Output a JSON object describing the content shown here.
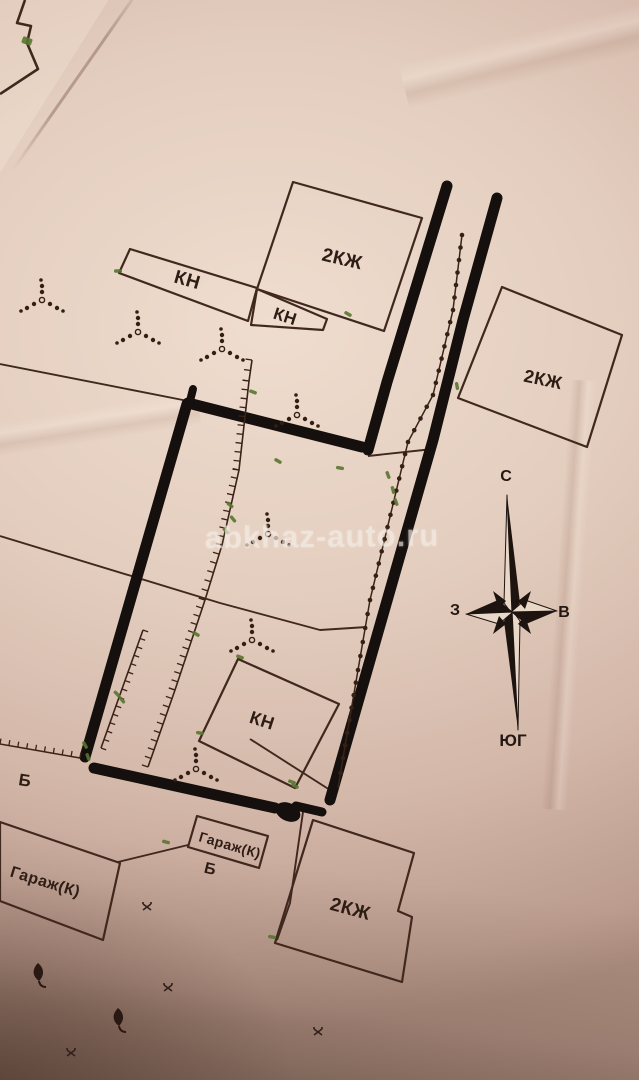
{
  "watermark": {
    "text": "abkhaz-auto.ru"
  },
  "compass": {
    "north_label": "С",
    "west_label": "З",
    "east_label": "В",
    "south_label": "ЮГ"
  },
  "buildings": {
    "kn_strip": "КН",
    "kn_small": "КН",
    "kn_center": "КН",
    "residential_top": "2КЖ",
    "residential_right": "2КЖ",
    "residential_bottom": "2КЖ",
    "garage_left": "Гараж(К)",
    "garage_center": "Гараж(К)"
  },
  "marks": {
    "b_left": "Б",
    "b_center": "Б"
  }
}
